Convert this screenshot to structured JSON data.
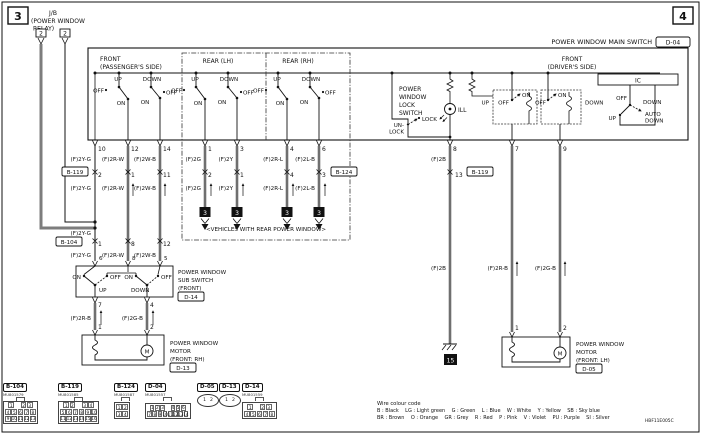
{
  "sheet": {
    "left": "3",
    "right": "4",
    "diagram_code": "HBF11E005C"
  },
  "relay": {
    "line1": "J/B",
    "line2": "(POWER WINDOW",
    "line3": "RELAY)",
    "pin_left": "2",
    "pin_right": "2"
  },
  "main_switch": {
    "title": "POWER WINDOW MAIN SWITCH",
    "connector": "D-04",
    "ic": "IC",
    "front_passenger_1": "FRONT",
    "front_passenger_2": "(PASSENGER'S SIDE)",
    "rear_lh": "REAR (LH)",
    "rear_rh": "REAR (RH)",
    "front_driver_1": "FRONT",
    "front_driver_2": "(DRIVER'S SIDE)",
    "up": "UP",
    "down": "DOWN",
    "on": "ON",
    "off": "OFF",
    "auto_down_1": "AUTO",
    "auto_down_2": "DOWN",
    "lock_switch_1": "POWER",
    "lock_switch_2": "WINDOW",
    "lock_switch_3": "LOCK",
    "lock_switch_4": "SWITCH",
    "unlock_1": "UN-",
    "unlock_2": "LOCK",
    "lock_pos": "LOCK",
    "ill": "ILL",
    "pins": {
      "fp_feed": "10",
      "fp_up": "12",
      "fp_down": "14",
      "rlh_up": "1",
      "rlh_down": "3",
      "rrh_up": "4",
      "rrh_down": "6",
      "ill": "8",
      "drv_up": "7",
      "drv_down": "9"
    }
  },
  "wires": {
    "w2yg": "(F)2Y-G",
    "w2rw": "(F)2R-W",
    "w2wb": "(F)2W-B",
    "w2g": "(F)2G",
    "w2y": "(F)2Y",
    "w2rl": "(F)2R-L",
    "w2lb": "(F)2L-B",
    "w2b": "(F)2B",
    "w2rb": "(F)2R-B",
    "w2gb": "(F)2G-B"
  },
  "inline_connectors": {
    "b119": {
      "label": "B-119",
      "pin_col1": "2",
      "pin_col2": "1",
      "pin_col3": "11",
      "pin_ill": "13"
    },
    "b104": {
      "label": "B-104",
      "pin_col1": "1",
      "pin_col2": "8",
      "pin_col3": "12"
    },
    "b124": {
      "label": "B-124",
      "pin_col1": "2",
      "pin_col2": "1",
      "pin_col3": "4",
      "pin_col4": "3"
    }
  },
  "rear_section": {
    "note": "<VEHICLES WITH REAR POWER WINDOW>",
    "to_sheet": "3"
  },
  "sub_switch": {
    "name_1": "POWER WINDOW",
    "name_2": "SUB SWITCH",
    "name_3": "(FRONT)",
    "connector": "D-14",
    "pin_in_1": "6",
    "pin_in_2": "8",
    "pin_in_3": "5",
    "pin_out_up": "7",
    "pin_out_down": "4",
    "on": "ON",
    "off": "OFF",
    "up": "UP",
    "down": "DOWN"
  },
  "motor_rh": {
    "name_1": "POWER WINDOW",
    "name_2": "MOTOR",
    "name_3": "(FRONT: RH)",
    "connector": "D-13",
    "pin_1": "1",
    "pin_2": "2",
    "symbol": "M"
  },
  "motor_lh": {
    "name_1": "POWER WINDOW",
    "name_2": "MOTOR",
    "name_3": "(FRONT: LH)",
    "connector": "D-05",
    "pin_1": "1",
    "pin_2": "2",
    "symbol": "M"
  },
  "ground": {
    "ref": "15"
  },
  "connectors_strip": [
    {
      "id": "B-104",
      "mu": "MU801579",
      "rows": [
        [
          "1",
          "",
          "2",
          "3"
        ],
        [
          "4",
          "5",
          "6",
          "7",
          "8"
        ],
        [
          "9",
          "10",
          "11",
          "12",
          "13"
        ]
      ]
    },
    {
      "id": "B-119",
      "mu": "MU801585",
      "rows": [
        [
          "1",
          "2",
          "",
          "3",
          "4"
        ],
        [
          "5",
          "6",
          "7",
          "8",
          "9",
          "10"
        ],
        [
          "11",
          "12",
          "13",
          "14",
          "15",
          "16"
        ]
      ]
    },
    {
      "id": "B-124",
      "mu": "MU801587",
      "rows": [
        [
          "1",
          "2"
        ],
        [
          "3",
          "4"
        ]
      ]
    },
    {
      "id": "D-04",
      "mu": "MU801557",
      "rows": [
        [
          "1",
          "2",
          "3",
          "",
          "4",
          "5",
          "6"
        ],
        [
          "7",
          "8",
          "9",
          "10",
          "11",
          "12",
          "13",
          "14"
        ]
      ]
    },
    {
      "id": "D-05",
      "oval": true,
      "pins": [
        "1",
        "2"
      ]
    },
    {
      "id": "D-13",
      "oval": true,
      "pins": [
        "1",
        "2"
      ]
    },
    {
      "id": "D-14",
      "mu": "MU801559",
      "rows": [
        [
          "1",
          "",
          "2",
          "3"
        ],
        [
          "4",
          "5",
          "6",
          "7",
          "8"
        ]
      ]
    }
  ],
  "colour_code": {
    "title": "Wire colour code",
    "line1": "B : Black    LG : Light green    G : Green    L : Blue    W : White    Y : Yellow    SB : Sky blue",
    "line2": "BR : Brown    O : Orange    GR : Grey    R : Red    P : Pink    V : Violet    PU : Purple    SI : Silver"
  }
}
